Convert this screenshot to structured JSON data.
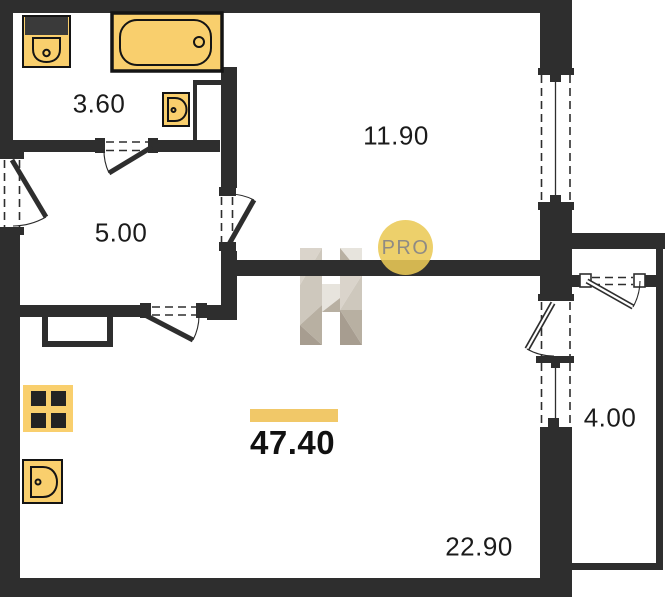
{
  "plan": {
    "title": "apartment-floor-plan",
    "total_area_label": "47.40",
    "rooms": [
      {
        "name": "bathroom",
        "area_label": "3.60"
      },
      {
        "name": "hallway",
        "area_label": "5.00"
      },
      {
        "name": "bedroom",
        "area_label": "11.90"
      },
      {
        "name": "kitchen-living-room",
        "area_label": "22.90"
      },
      {
        "name": "balcony",
        "area_label": "4.00"
      }
    ],
    "watermark_text": "PRO"
  },
  "colors": {
    "wall": "#2e2e2e",
    "fixture_fill": "#f9cf6d",
    "fixture_outline": "#141414",
    "accent_bar": "#f1c868",
    "logo_circle": "#eac957",
    "logo_text": "#8f8b84",
    "label_text": "#1b1b1b",
    "wm_a": "#e7e3dc",
    "wm_b": "#cdc6bb",
    "wm_c": "#b6ad9f",
    "wm_d": "#d9d3c9",
    "wm_e": "#a49a8c"
  }
}
